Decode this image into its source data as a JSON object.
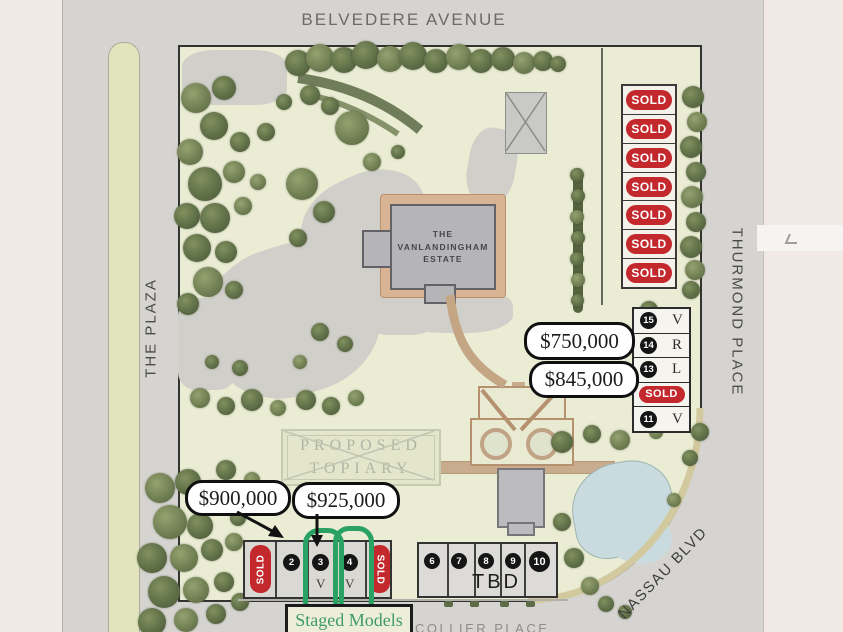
{
  "streets": {
    "top": "BELVEDERE AVENUE",
    "left": "THE PLAZA",
    "right": "THURMOND PLACE",
    "southeast": "NASSAU BLVD",
    "bottom": "COLLIER PLACE"
  },
  "estate": {
    "line1": "THE",
    "line2": "VANLANDINGHAM",
    "line3": "ESTATE"
  },
  "topiary": {
    "line1": "PROPOSED",
    "line2": "TOPIARY"
  },
  "sold_column": [
    "SOLD",
    "SOLD",
    "SOLD",
    "SOLD",
    "SOLD",
    "SOLD",
    "SOLD"
  ],
  "east_lots": [
    {
      "num": "15",
      "letter": "V"
    },
    {
      "num": "14",
      "letter": "R"
    },
    {
      "num": "13",
      "letter": "L"
    },
    {
      "sold": "SOLD"
    },
    {
      "num": "11",
      "letter": "V"
    }
  ],
  "price_callouts": {
    "p750": "$750,000",
    "p845": "$845,000",
    "p900": "$900,000",
    "p925": "$925,000"
  },
  "south_west_row": {
    "sold_left": "SOLD",
    "lot2": "2",
    "lot3": {
      "num": "3",
      "letter": "V"
    },
    "lot4": {
      "num": "4",
      "letter": "V"
    },
    "sold_right": "SOLD"
  },
  "south_mid_row": {
    "lots": [
      "6",
      "7",
      "8",
      "9",
      "10"
    ],
    "status": "TBD"
  },
  "legend": {
    "staged_models": "Staged Models"
  },
  "colors": {
    "sold_red": "#c3282c",
    "highlight_green": "#2aa263",
    "lawn_green": "#eaecd3",
    "pond_blue": "#c9dbdf",
    "path_tan": "#c9ab8d"
  }
}
